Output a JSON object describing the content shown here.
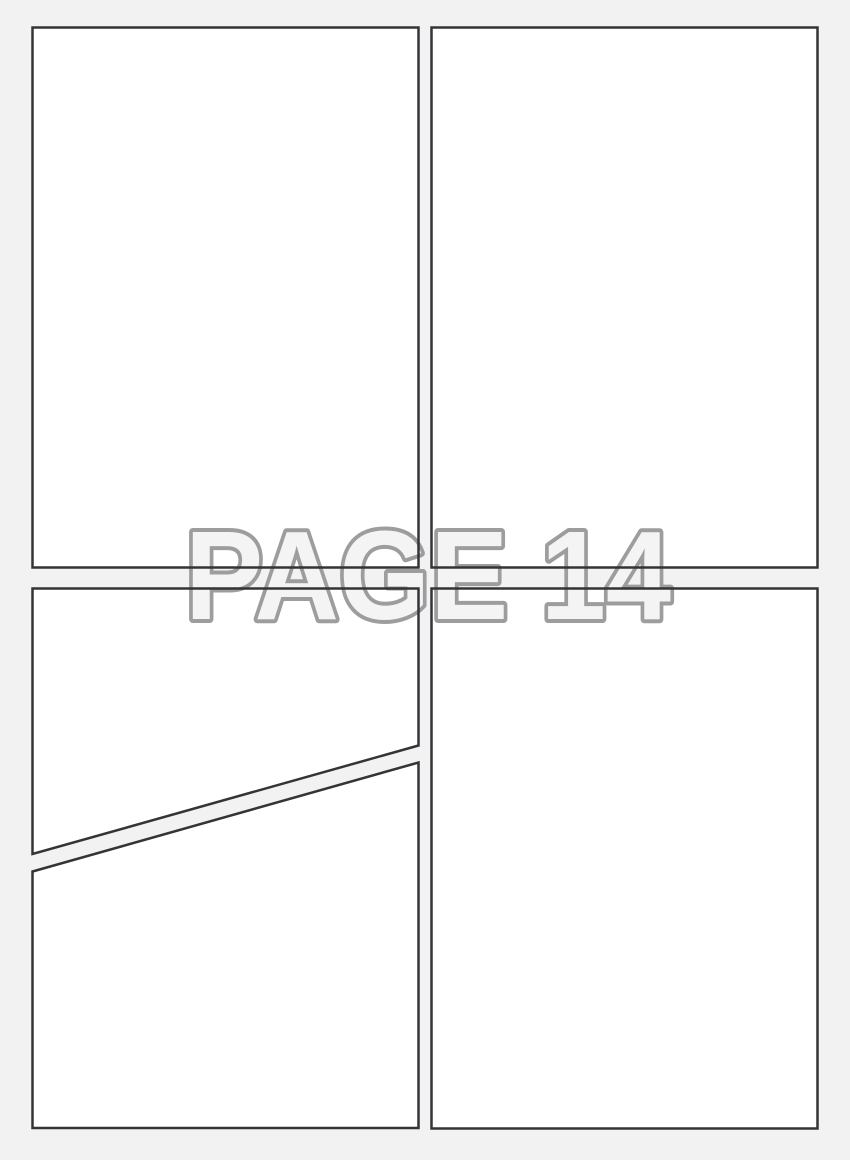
{
  "page_label": {
    "text": "PAGE 14"
  },
  "colors": {
    "background": "#f2f2f2",
    "panel_fill": "#ffffff",
    "panel_border": "#343438",
    "label_fill": "#f4f4f4",
    "label_outline": "#9d9d9d"
  },
  "panels": [
    {
      "id": "top-left"
    },
    {
      "id": "top-right"
    },
    {
      "id": "bottom-left-upper"
    },
    {
      "id": "bottom-left-lower"
    },
    {
      "id": "bottom-right"
    }
  ]
}
